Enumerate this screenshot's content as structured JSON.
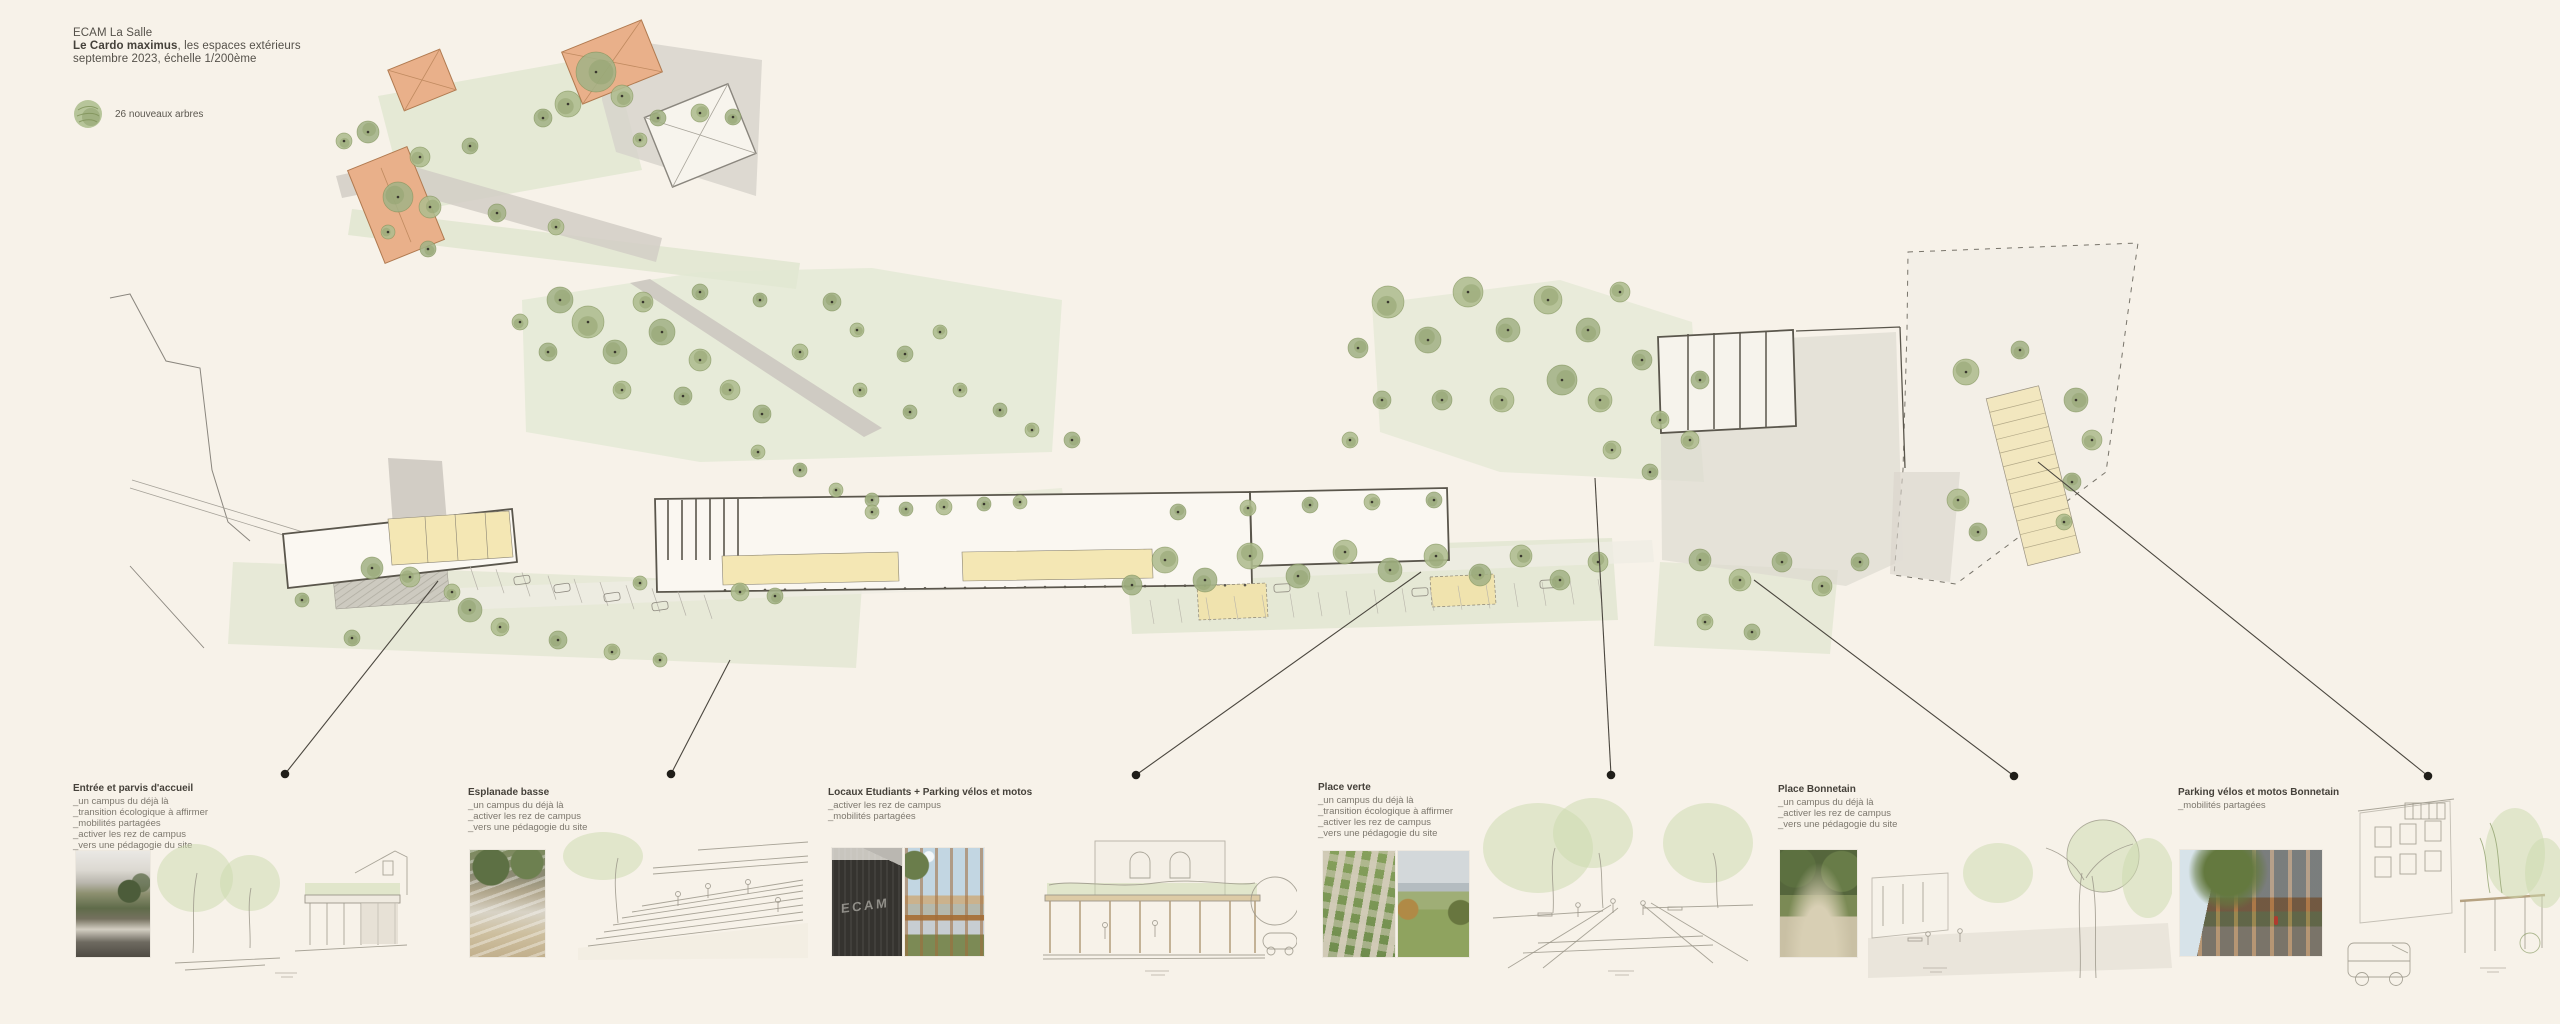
{
  "board": {
    "title_block": {
      "line1": "ECAM La Salle",
      "line2_bold": "Le Cardo maximus",
      "line2_rest": ", les espaces extérieurs",
      "line3": "septembre 2023, échelle 1/200ème"
    },
    "legend": {
      "label": "26 nouveaux arbres"
    },
    "annotations": [
      {
        "title": "Entrée et parvis d'accueil",
        "bullets": [
          "_un campus du déjà là",
          "_transition écologique à affirmer",
          "_mobilités partagées",
          "_activer les rez de campus",
          "_vers une pédagogie du site"
        ]
      },
      {
        "title": "Esplanade basse",
        "bullets": [
          "_un campus du déjà là",
          "_activer les rez de campus",
          "_vers une pédagogie du site"
        ]
      },
      {
        "title": "Locaux Etudiants + Parking vélos et motos",
        "bullets": [
          "_activer les rez de campus",
          "_mobilités partagées"
        ]
      },
      {
        "title": "Place verte",
        "bullets": [
          "_un campus du déjà là",
          "_transition écologique à affirmer",
          "_activer les rez de campus",
          "_vers une pédagogie du site"
        ]
      },
      {
        "title": "Place Bonnetain",
        "bullets": [
          "_un campus du déjà là",
          "_activer les rez de campus",
          "_vers une pédagogie du site"
        ]
      },
      {
        "title": "Parking vélos et motos Bonnetain",
        "bullets": [
          "_mobilités partagées"
        ]
      }
    ],
    "photos": {
      "ecam_sign": "ECAM"
    },
    "colors": {
      "background": "#f7f2e9",
      "lawn": "#e0e6d0",
      "tree": "#aebc8e",
      "tree_dark": "#93a471",
      "path_gray": "#d6d2cb",
      "roof_orange": "#e9b08a",
      "room_yellow": "#f4e7b4",
      "wall_ink": "#5a564c",
      "leader_ink": "#201e19"
    }
  }
}
